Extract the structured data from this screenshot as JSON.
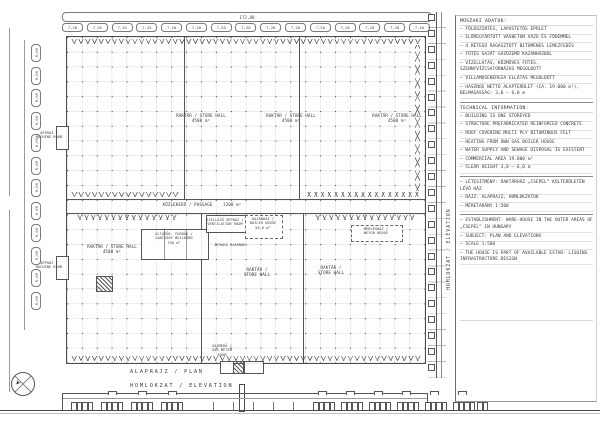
{
  "titles": {
    "plan": "ALAPRAJZ / PLAN",
    "elevation": "HOMLOKZAT / ELEVATION",
    "side": "HOMLOKZAT / ELEVATION"
  },
  "dims": {
    "top_overall": "172,80",
    "top_bay_label": "7,20",
    "top_bay_count": 15,
    "left_bay_label": "6,00",
    "left_bay_count": 12
  },
  "icons": {
    "north_arrow": "➤"
  },
  "rooms": {
    "hall": "RAKTÁR / STORE HALL",
    "hall1": "RAKTÁR /",
    "hall2": "STORE HALL",
    "hall_area": "4500 m²",
    "passage": "KÖZLEKEDŐ / PASSAGE",
    "passage_area": "1200 m²",
    "sanitary1": "ÖLTÖZŐK, FÜRDŐK /",
    "sanitary2": "SANITARY BUILDING",
    "sanitary_area": "750 m²",
    "vent1": "SZELLŐZŐ GÉPHÁZ /",
    "vent2": "VENTILATION ROOM",
    "boiler1": "KAZÁNHÁZ /",
    "boiler2": "BOILER HOUSE",
    "boiler_area": "90,0 m²",
    "weigh1": "MÉRLEGHÁZ /",
    "weigh2": "WEIGH HOUSE",
    "transfer": "ÁTRAKÓ CSARNOK",
    "machine1": "GÉPHÁZ /",
    "machine2": "MACHINE ROOM",
    "gas1": "GÁZMÉRŐ /",
    "gas2": "GAS METER",
    "gas3": "ROOM"
  },
  "notes": {
    "hu": {
      "heading": "MŰSZAKI ADATOK:",
      "items": [
        "– FÖLDSZINTES, LAPOSTETŐS ÉPÜLET",
        "– ELŐREGYÁRTOTT VASBETON VÁZÚ ÉS FÖDÉMMEL",
        "– 4 RÉTEGŰ RAGASZTOTT BITUMENES LEMEZFEDÉS",
        "– FŰTÉS SAJÁT GÁZÜZEMŰ KAZÁNHÁZBÓL",
        "– VÍZELLÁTÁS, KÖZMŰVES FŰTÉS, SZENNYVÍZCSATORNÁZÁS MEGOLDOTT",
        "– VILLAMOSENERGIA ELLÁTÁS MEGOLDOTT",
        "– HASZNOS NETTÓ ALAPTERÜLET (CA. 19.000 m²), BELMAGASSÁG: 3,0 – 6,0 m"
      ]
    },
    "en": {
      "heading": "TECHNICAL INFORMATION:",
      "items": [
        "– BUILDING IS ONE STOREYED",
        "– STRUCTURE PREFABRICATED REINFORCED CONCRETE",
        "– ROOF COVERING MULTI PLY BITUMINOUS FELT",
        "– HEATING FROM OWN GAS BOILER HOUSE",
        "– WATER SUPPLY AND SEWAGE DISPOSAL IS EXISTENT",
        "– COMMERCIAL AREA 19.000 m²",
        "– CLEAR HEIGHT 3,0 – 6,0 m"
      ]
    },
    "project_hu": {
      "items": [
        "– LÉTESÍTMÉNY: RAKTÁRHÁZ „CSEPEL” KÜLTERÜLETÉN LÉVŐ HÁZ",
        "– RAJZ: ALAPRAJZ, HOMLOKZATOK",
        "– MÉRETARÁNY 1:500"
      ]
    },
    "project_en": {
      "items": [
        "– ESTABLISHMENT: WARE-HOUSE IN THE OUTER AREAS OF „CSEPEL” IN HUNGARY",
        "– SUBJECT: PLAN AND ELEVATIONS",
        "– SCALE 1:500",
        "– THE HOUSE IS PART OF AVAILABLE ESTAB- LISHING INFRASTRUCTURE DESIGN"
      ]
    }
  }
}
